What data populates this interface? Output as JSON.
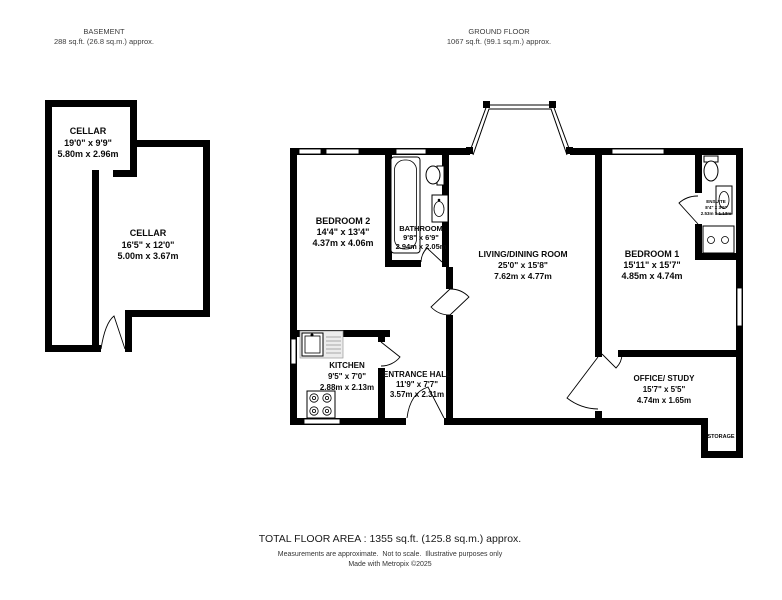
{
  "page": {
    "background": "#ffffff",
    "wall_color": "#000000",
    "text_color": "#000000",
    "muted_text_color": "#3d3d3d"
  },
  "basement": {
    "title": "BASEMENT",
    "area": "288 sq.ft. (26.8 sq.m.) approx.",
    "rooms": {
      "cellar1": {
        "name": "CELLAR",
        "imperial": "19'0\" x 9'9\"",
        "metric": "5.80m x 2.96m"
      },
      "cellar2": {
        "name": "CELLAR",
        "imperial": "16'5\" x 12'0\"",
        "metric": "5.00m x 3.67m"
      }
    }
  },
  "ground_floor": {
    "title": "GROUND FLOOR",
    "area": "1067 sq.ft. (99.1 sq.m.) approx.",
    "rooms": {
      "bedroom2": {
        "name": "BEDROOM 2",
        "imperial": "14'4\" x 13'4\"",
        "metric": "4.37m x 4.06m"
      },
      "bathroom": {
        "name": "BATHROOM",
        "imperial": "9'8\" x 6'9\"",
        "metric": "2.94m x 2.05m"
      },
      "living_dining": {
        "name": "LIVING/DINING ROOM",
        "imperial": "25'0\" x 15'8\"",
        "metric": "7.62m x 4.77m"
      },
      "bedroom1": {
        "name": "BEDROOM 1",
        "imperial": "15'11\" x 15'7\"",
        "metric": "4.85m x 4.74m"
      },
      "ensuite": {
        "name": "ENSUITE",
        "imperial": "8'4\" x 3'9\"",
        "metric": "2.53m x 1.13m"
      },
      "kitchen": {
        "name": "KITCHEN",
        "imperial": "9'5\" x 7'0\"",
        "metric": "2.88m x 2.13m"
      },
      "entrance_hall": {
        "name": "ENTRANCE HALL",
        "imperial": "11'9\" x 7'7\"",
        "metric": "3.57m x 2.31m"
      },
      "office_study": {
        "name": "OFFICE/ STUDY",
        "imperial": "15'7\" x 5'5\"",
        "metric": "4.74m x 1.65m"
      },
      "storage": {
        "name": "STORAGE"
      }
    }
  },
  "footer": {
    "total": "TOTAL FLOOR AREA : 1355 sq.ft. (125.8 sq.m.) approx.",
    "disclaimer": "Measurements are approximate.  Not to scale.  Illustrative purposes only",
    "credit": "Made with Metropix ©2025"
  }
}
